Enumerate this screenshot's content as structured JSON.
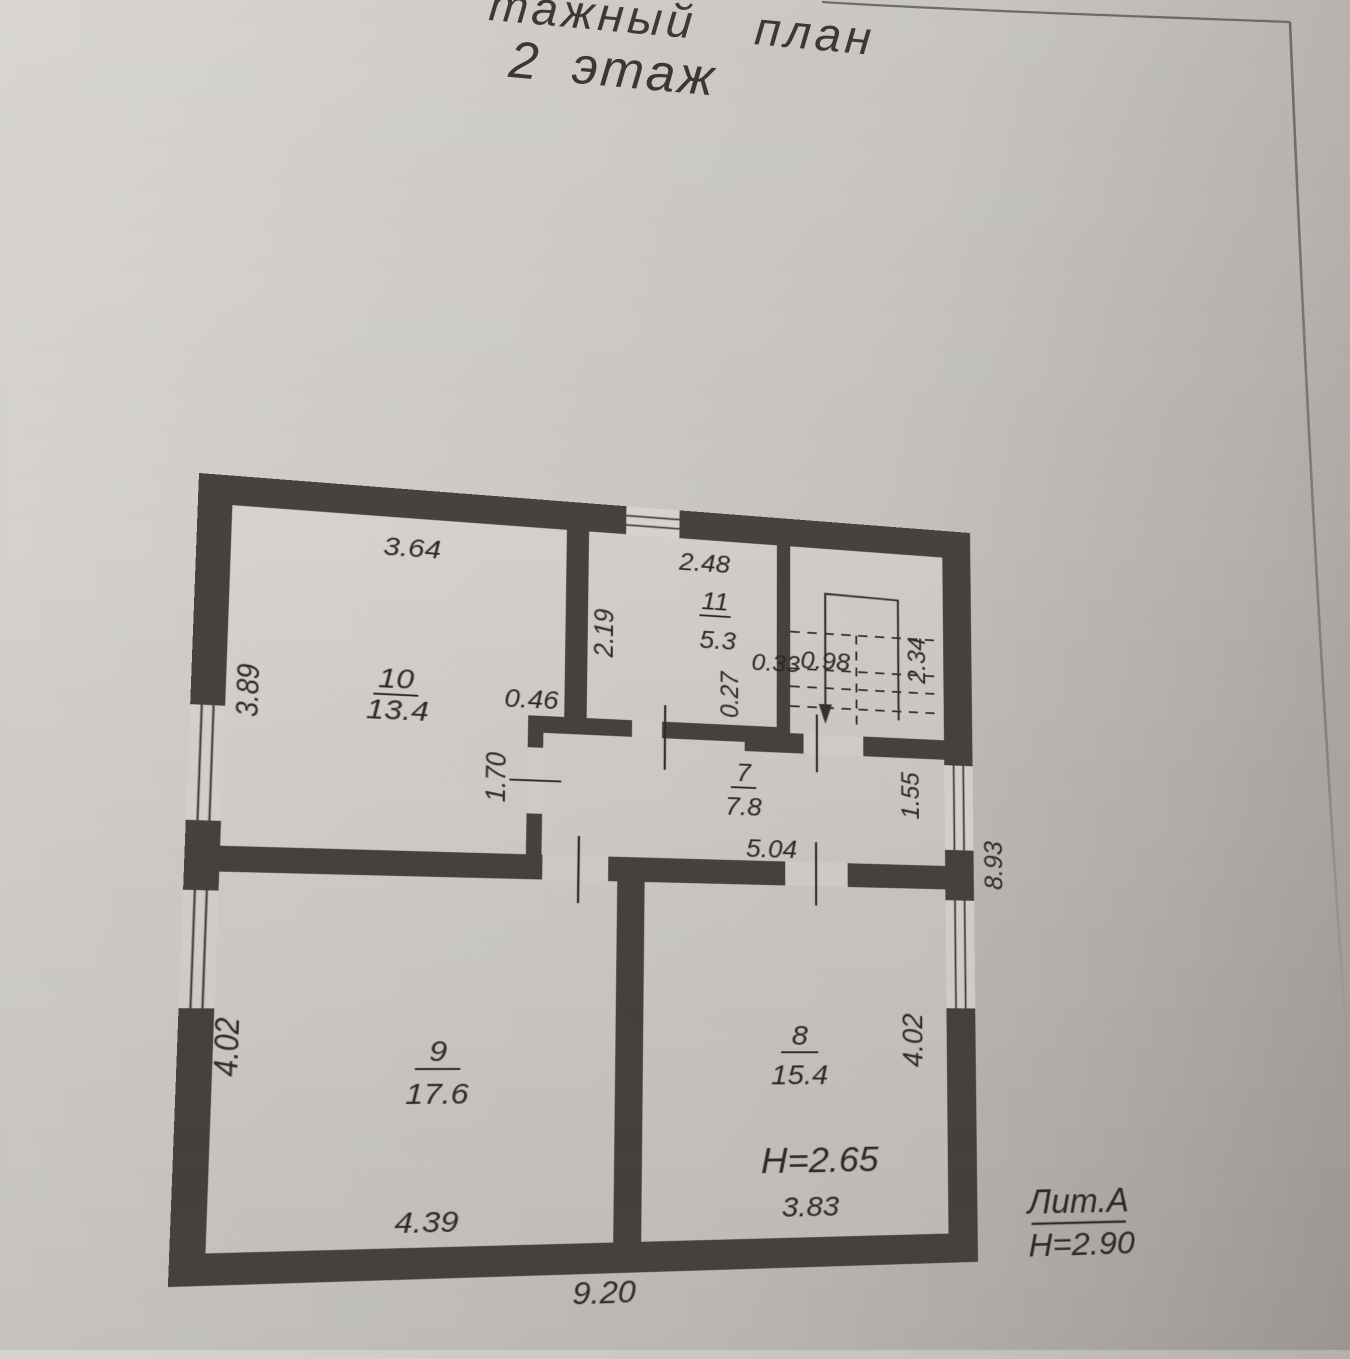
{
  "title": {
    "line1": "тажный план",
    "line2": "2 этаж"
  },
  "plan": {
    "rooms": [
      {
        "number": "10",
        "area": "13.4"
      },
      {
        "number": "11",
        "area": "5.3"
      },
      {
        "number": "7",
        "area": "7.8"
      },
      {
        "number": "9",
        "area": "17.6"
      },
      {
        "number": "8",
        "area": "15.4"
      }
    ],
    "dims": {
      "room10_width": "3.64",
      "room10_depth": "3.89",
      "room11_width": "2.48",
      "room11_depth": "2.19",
      "wall_jog": "0.46",
      "step_width": "0.33",
      "step_depth": "0.27",
      "stair_well": "0.98",
      "stair_depth": "2.34",
      "door_opening": "1.70",
      "room7_width": "5.04",
      "room7_depth": "1.55",
      "house_depth": "8.93",
      "room9_depth": "4.02",
      "room9_width": "4.39",
      "room8_width": "3.83",
      "room8_depth": "4.02",
      "house_width": "9.20",
      "room8_ceiling": "H=2.65"
    },
    "litera": {
      "label": "Лит.А",
      "ceiling": "H=2.90"
    },
    "colors": {
      "wall": "#46423e",
      "ink": "#2d2a26",
      "paper": "#cdcac6"
    }
  }
}
